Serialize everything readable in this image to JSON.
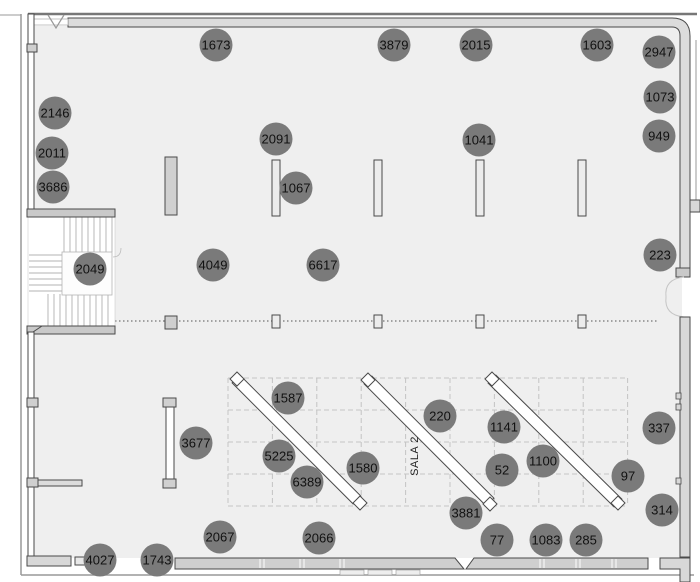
{
  "plan": {
    "room_label": "SALA 2",
    "floor_color": "#efefef",
    "wall_fill": "#d8d8d8",
    "wall_stroke": "#4a4a4a",
    "grid_color": "#c4c4c4"
  },
  "marker_style": {
    "fill": "#7a7a7a",
    "text_color": "#111111",
    "radius": 16.5
  },
  "markers": [
    {
      "label": "1673",
      "x": 216,
      "y": 45
    },
    {
      "label": "3879",
      "x": 394,
      "y": 45
    },
    {
      "label": "2015",
      "x": 476,
      "y": 45
    },
    {
      "label": "1603",
      "x": 597,
      "y": 45
    },
    {
      "label": "2947",
      "x": 659,
      "y": 52
    },
    {
      "label": "1073",
      "x": 660,
      "y": 97
    },
    {
      "label": "2146",
      "x": 55,
      "y": 113
    },
    {
      "label": "949",
      "x": 659,
      "y": 136
    },
    {
      "label": "2091",
      "x": 276,
      "y": 139
    },
    {
      "label": "1041",
      "x": 479,
      "y": 140
    },
    {
      "label": "2011",
      "x": 52,
      "y": 153
    },
    {
      "label": "3686",
      "x": 53,
      "y": 187
    },
    {
      "label": "1067",
      "x": 296,
      "y": 188
    },
    {
      "label": "2049",
      "x": 90,
      "y": 269
    },
    {
      "label": "4049",
      "x": 213,
      "y": 265
    },
    {
      "label": "6617",
      "x": 323,
      "y": 265
    },
    {
      "label": "223",
      "x": 660,
      "y": 255
    },
    {
      "label": "1587",
      "x": 288,
      "y": 398
    },
    {
      "label": "220",
      "x": 440,
      "y": 416
    },
    {
      "label": "1141",
      "x": 504,
      "y": 427
    },
    {
      "label": "337",
      "x": 659,
      "y": 428
    },
    {
      "label": "3677",
      "x": 196,
      "y": 443
    },
    {
      "label": "5225",
      "x": 279,
      "y": 456
    },
    {
      "label": "1100",
      "x": 543,
      "y": 461
    },
    {
      "label": "1580",
      "x": 363,
      "y": 468
    },
    {
      "label": "52",
      "x": 502,
      "y": 470
    },
    {
      "label": "97",
      "x": 628,
      "y": 476
    },
    {
      "label": "6389",
      "x": 307,
      "y": 482
    },
    {
      "label": "314",
      "x": 662,
      "y": 510
    },
    {
      "label": "3881",
      "x": 466,
      "y": 513
    },
    {
      "label": "2067",
      "x": 220,
      "y": 537
    },
    {
      "label": "2066",
      "x": 319,
      "y": 538
    },
    {
      "label": "77",
      "x": 497,
      "y": 540
    },
    {
      "label": "1083",
      "x": 546,
      "y": 540
    },
    {
      "label": "285",
      "x": 586,
      "y": 540
    },
    {
      "label": "4027",
      "x": 100,
      "y": 560
    },
    {
      "label": "1743",
      "x": 157,
      "y": 560
    }
  ]
}
